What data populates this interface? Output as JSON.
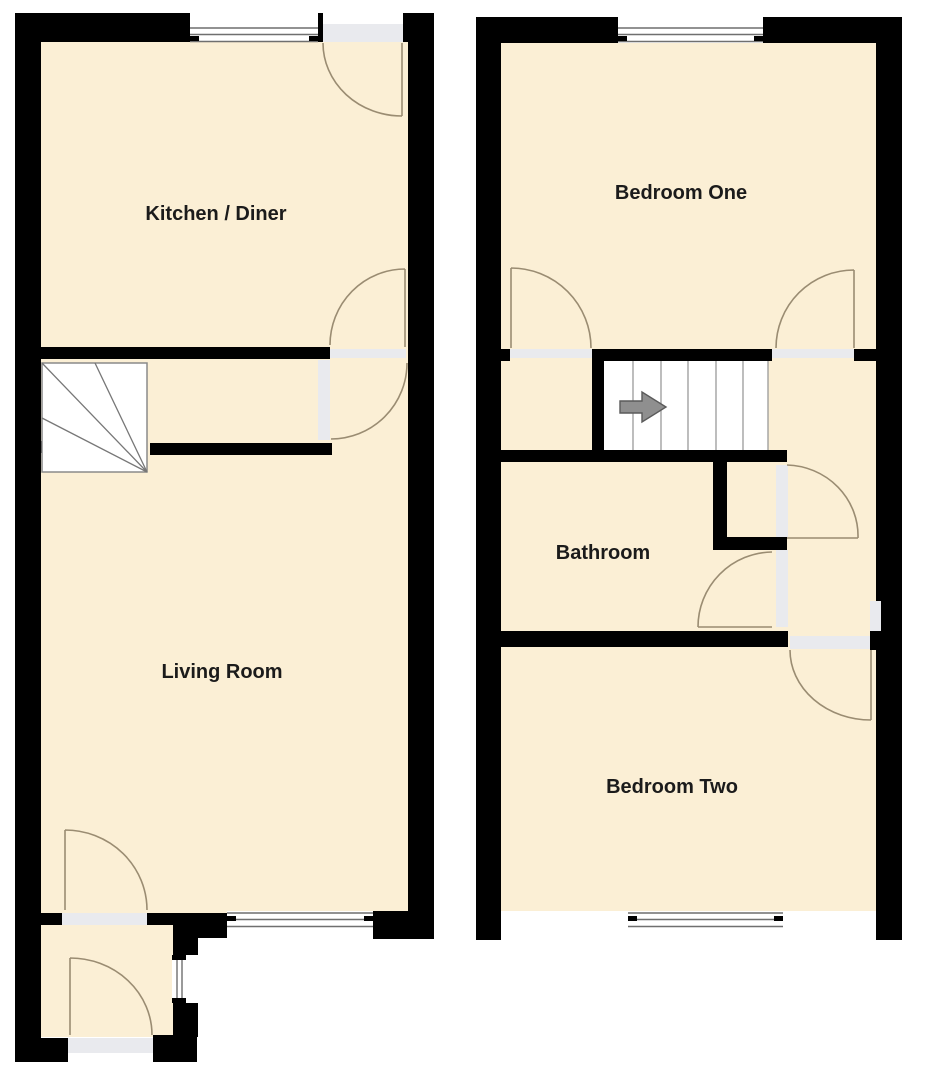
{
  "colors": {
    "background": "#ffffff",
    "wall": "#000000",
    "floor": "#fbefd5",
    "threshold": "#e9eaee",
    "window_line": "#6f6f6f",
    "door_arc": "#9a8c72",
    "stair_line": "#9a9a9a",
    "stair_fan_line": "#777777",
    "arrow_fill": "#8f8f8f",
    "arrow_stroke": "#5a5a5a",
    "label": "#1b1b1b"
  },
  "ground_floor": {
    "rooms": [
      {
        "label": "Kitchen / Diner"
      },
      {
        "label": "Living Room"
      }
    ]
  },
  "first_floor": {
    "rooms": [
      {
        "label": "Bedroom One"
      },
      {
        "label": "Bathroom"
      },
      {
        "label": "Bedroom Two"
      }
    ]
  },
  "labels": {
    "kitchen_diner": "Kitchen / Diner",
    "living_room": "Living Room",
    "bedroom_one": "Bedroom One",
    "bathroom": "Bathroom",
    "bedroom_two": "Bedroom Two"
  }
}
